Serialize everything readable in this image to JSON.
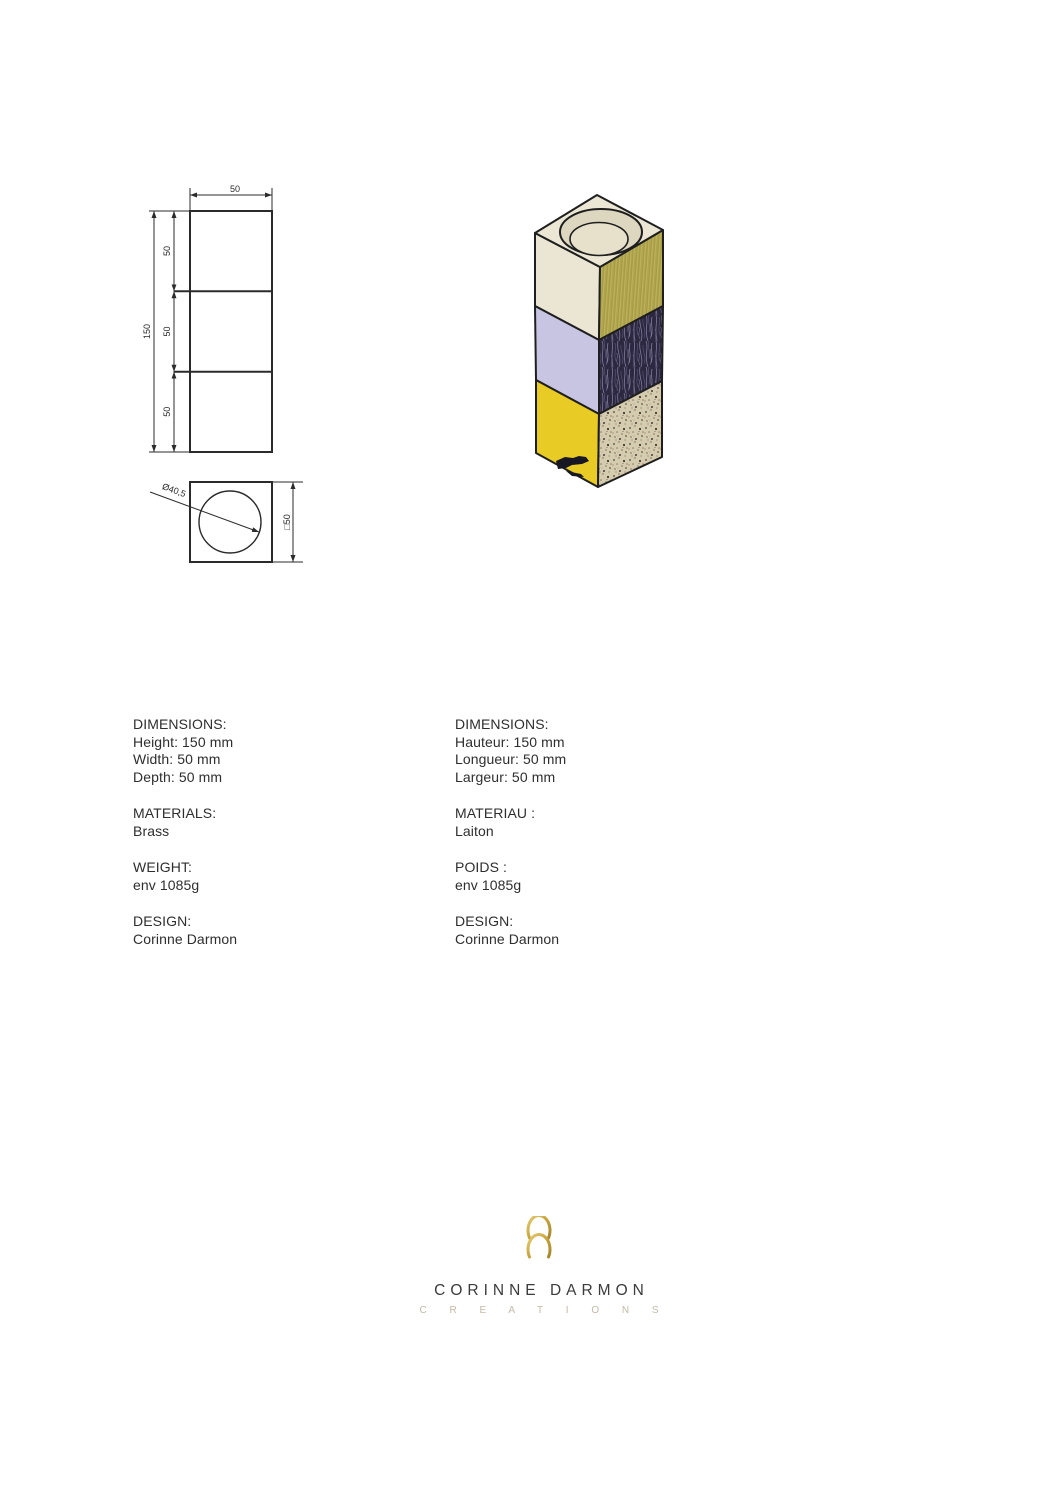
{
  "front_view": {
    "width_label": "50",
    "height_label": "150",
    "segment_labels": [
      "50",
      "50",
      "50"
    ]
  },
  "top_view": {
    "diameter_label": "Ø40,5",
    "side_label": "□50"
  },
  "iso_render": {
    "colors": {
      "outline": "#1f1f1f",
      "top_face": "#ece7d4",
      "hole_wall": "#ded7c0",
      "hole_bottom": "#e7e1cc",
      "left_top": "#ebe6d4",
      "left_mid": "#c8c5e3",
      "left_bottom": "#e8cb24",
      "right_top": "#b2a74f",
      "right_mid": "#2c2840",
      "right_bottom": "#d5cbae"
    }
  },
  "specs_en": {
    "sections": [
      {
        "heading": "DIMENSIONS:",
        "lines": [
          "Height: 150 mm",
          "Width: 50 mm",
          "Depth: 50 mm"
        ]
      },
      {
        "heading": "MATERIALS:",
        "lines": [
          "Brass"
        ]
      },
      {
        "heading": "WEIGHT:",
        "lines": [
          "env 1085g"
        ]
      },
      {
        "heading": "DESIGN:",
        "lines": [
          "Corinne Darmon"
        ]
      }
    ]
  },
  "specs_fr": {
    "sections": [
      {
        "heading": "DIMENSIONS:",
        "lines": [
          "Hauteur: 150 mm",
          "Longueur: 50 mm",
          "Largeur: 50 mm"
        ]
      },
      {
        "heading": "MATERIAU :",
        "lines": [
          "Laiton"
        ]
      },
      {
        "heading": "POIDS :",
        "lines": [
          "env 1085g"
        ]
      },
      {
        "heading": "DESIGN:",
        "lines": [
          "Corinne Darmon"
        ]
      }
    ]
  },
  "logo": {
    "name": "CORINNE DARMON",
    "subtitle": "C R E A T I O N S",
    "gold": "#c7a53f",
    "name_color": "#3b3b3b",
    "subtitle_color": "#c3baa6"
  }
}
